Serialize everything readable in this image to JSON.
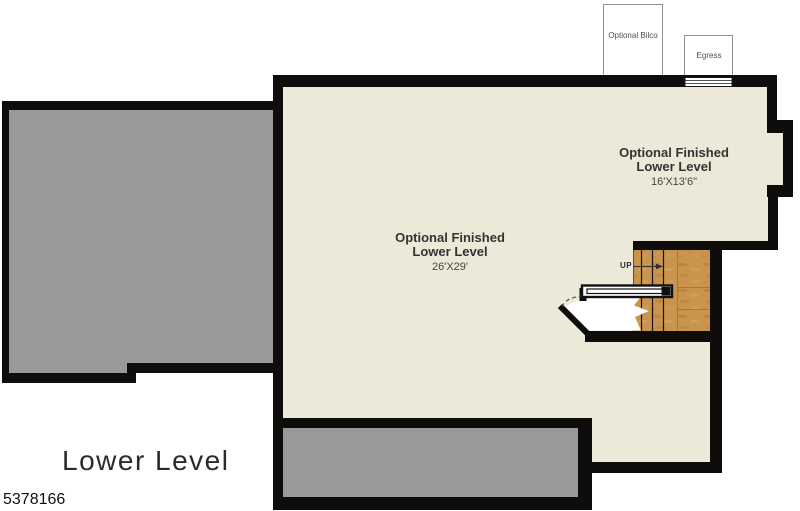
{
  "plan": {
    "title": "Lower Level",
    "listing_number": "5378166",
    "colors": {
      "wall": "#0e0d0b",
      "floor_cream": "#ece9d8",
      "unfinished_gray": "#999999",
      "wood_base": "#c9944e",
      "wood_grain_dark": "#b07a38",
      "wood_grain_light": "#d8a75f",
      "outline_white": "#ffffff"
    },
    "exterior_features": [
      {
        "label": "Optional Bilco"
      },
      {
        "label": "Egress"
      }
    ],
    "rooms": [
      {
        "line1": "Optional Finished",
        "line2": "Lower Level",
        "dimensions": "26'X29'"
      },
      {
        "line1": "Optional Finished",
        "line2": "Lower Level",
        "dimensions": "16'X13'6\""
      }
    ],
    "stairs": {
      "direction_label": "UP"
    }
  }
}
